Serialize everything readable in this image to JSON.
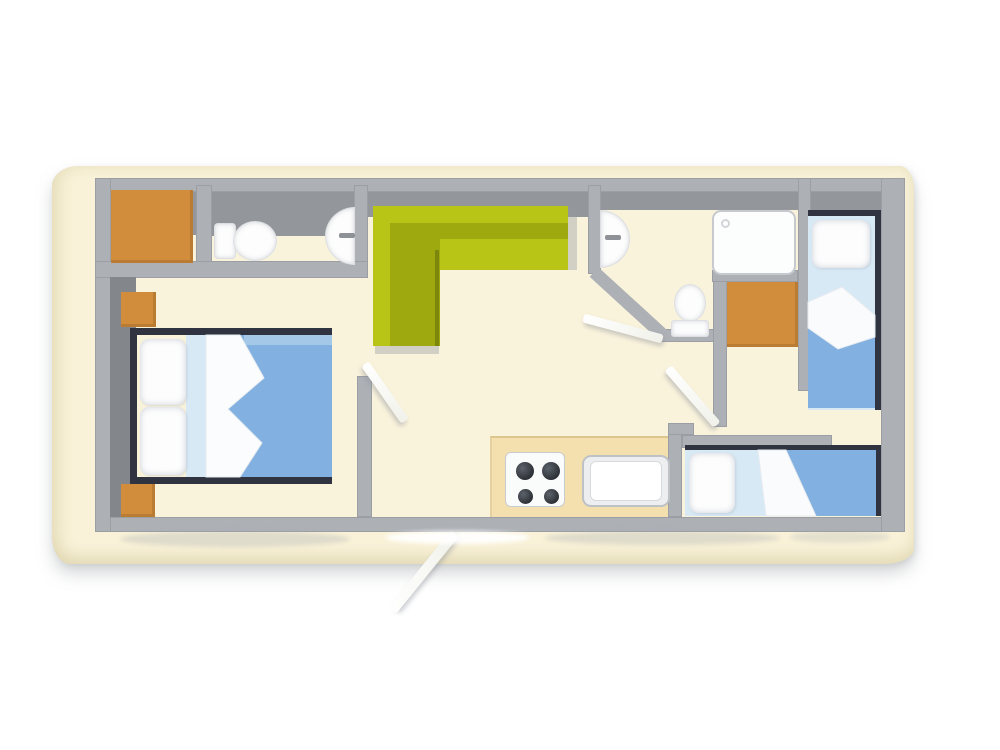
{
  "scene": {
    "kind": "floor-plan-illustration",
    "subject": "holiday mobile-home floor plan, top-down view on cream paper"
  },
  "colors": {
    "background": "#ffffff",
    "paper": "#f9f2d8",
    "floor": "#faf3dc",
    "wall": "#adb1b6",
    "wall_dark_band": "#93979b",
    "headboard": "#83878c",
    "furniture_orange": "#d18d3c",
    "sofa_green": "#b8c416",
    "sofa_green_dark": "#9da90f",
    "bed_duvet_blue": "#82b0e0",
    "bed_sheet_blue": "#d7e9f5",
    "kitchen_counter_tan": "#f4e0ae",
    "fixture_white": "#fdfdfd",
    "bed_frame_dark": "#2f3440"
  },
  "rooms": [
    {
      "id": "master-bedroom",
      "furniture": [
        "double-bed",
        "pillow",
        "pillow",
        "folded-blanket",
        "nightstand",
        "nightstand",
        "headboard",
        "wardrobe"
      ]
    },
    {
      "id": "bathroom-1",
      "furniture": [
        "toilet",
        "washbasin"
      ]
    },
    {
      "id": "living-room",
      "furniture": [
        "corner-sofa"
      ]
    },
    {
      "id": "kitchen",
      "furniture": [
        "counter",
        "stove-4-burner",
        "kitchen-sink"
      ]
    },
    {
      "id": "bathroom-2",
      "furniture": [
        "washbasin",
        "toilet",
        "shower-tray"
      ]
    },
    {
      "id": "bedroom-2",
      "furniture": [
        "single-bed",
        "pillow",
        "rolled-blanket",
        "wardrobe"
      ]
    },
    {
      "id": "bedroom-3",
      "furniture": [
        "single-bed",
        "pillow",
        "folded-blanket"
      ]
    }
  ],
  "doors": [
    {
      "id": "master-bedroom-door",
      "state": "open"
    },
    {
      "id": "bathroom-2-door",
      "state": "open"
    },
    {
      "id": "hallway-door",
      "state": "open"
    },
    {
      "id": "entry-door",
      "state": "open",
      "location": "bottom-exterior"
    }
  ]
}
